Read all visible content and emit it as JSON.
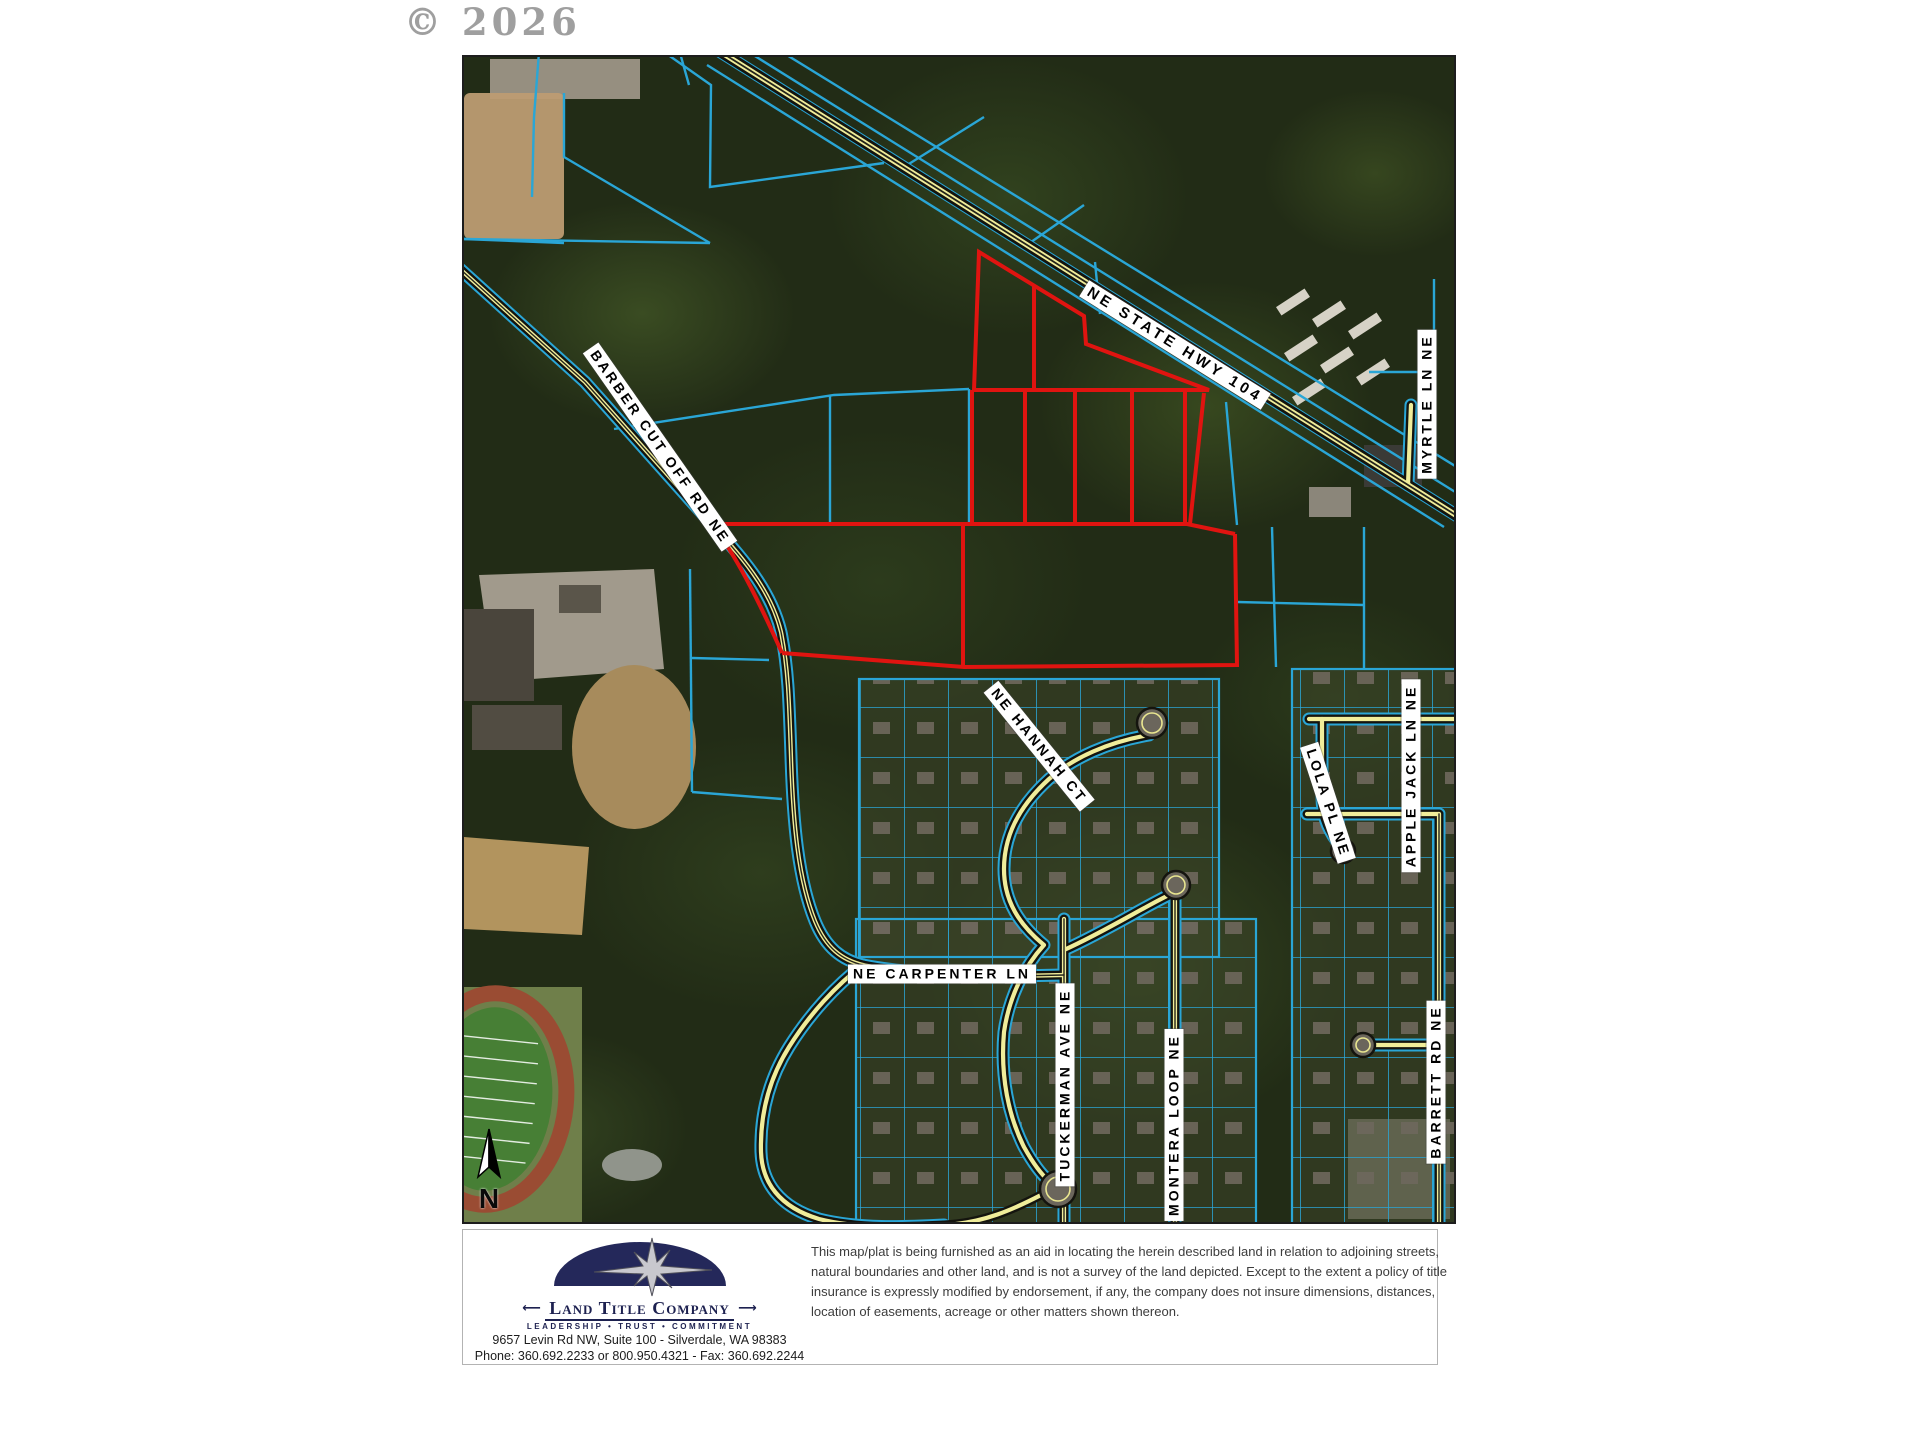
{
  "watermark": "© 2026",
  "map": {
    "north_label": "N",
    "roads": {
      "hwy104": "NE STATE HWY 104",
      "barber": "BARBER CUT OFF RD NE",
      "myrtle": "MYRTLE LN NE",
      "hannah": "NE HANNAH CT",
      "lola": "LOLA PL NE",
      "applejack": "APPLE JACK LN NE",
      "carpenter": "NE CARPENTER LN",
      "tuckerman": "TUCKERMAN AVE NE",
      "montera": "MONTERA LOOP NE",
      "barrett": "BARRETT RD NE"
    },
    "colors": {
      "parcel_line": "#2aa6d6",
      "subject_outline": "#e01410",
      "road_centerline": "#f0ed9a",
      "label_background": "#ffffff"
    }
  },
  "footer": {
    "company": "Land Title Company",
    "tagline": "LEADERSHIP • TRUST • COMMITMENT",
    "address": "9657 Levin Rd NW, Suite 100 - Silverdale, WA 98383",
    "phone_fax": "Phone: 360.692.2233 or 800.950.4321 - Fax: 360.692.2244",
    "disclaimer": "This map/plat is being furnished as an aid in locating the herein described land in relation to adjoining streets, natural boundaries and other land, and is not a survey of the land depicted. Except to the extent a policy of title insurance is expressly modified by endorsement, if any, the company does not insure dimensions, distances, location of easements, acreage or other matters shown thereon."
  }
}
